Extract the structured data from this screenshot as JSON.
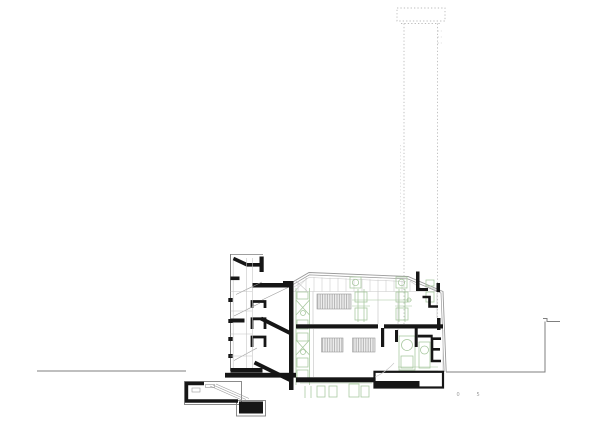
{
  "document": {
    "kind": "architectural-section-drawing",
    "scale_bar": {
      "tick_labels": [
        "0",
        "5"
      ]
    },
    "colors": {
      "paper": "#ffffff",
      "ink": "#161616",
      "wall_gray": "#7f7f7f",
      "line_mid": "#9a9a9a",
      "line_light": "#c6c6c6",
      "dotted": "#bcbcbc",
      "green": "#a5c69c",
      "window_bg": "#ededed",
      "window_line": "#9f9f9f"
    }
  }
}
